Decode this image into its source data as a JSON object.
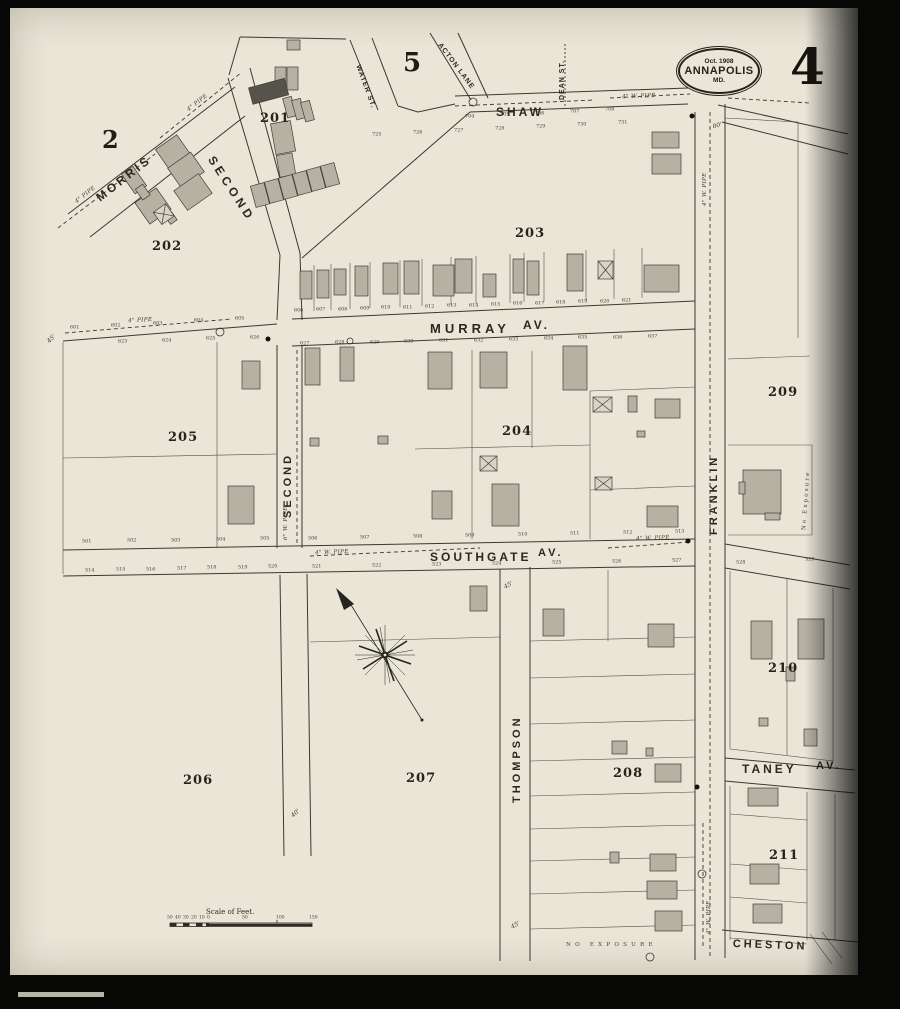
{
  "sheet": {
    "number": "4",
    "badge_date": "Oct. 1908",
    "badge_city": "ANNAPOLIS",
    "badge_state": "MD.",
    "adjacent_top": "5",
    "adjacent_left": "2"
  },
  "streets": {
    "shaw": "SHAW",
    "morris": "MORRIS",
    "second_upper": "SECOND",
    "second_lower": "SECOND",
    "water": "WATER ST.",
    "acton": "ACTON LANE",
    "dean": "DEAN ST.",
    "murray": "MURRAY",
    "murray_av": "AV.",
    "southgate": "SOUTHGATE",
    "southgate_av": "AV.",
    "franklin": "FRANKLIN",
    "thompson": "THOMPSON",
    "taney": "TANEY",
    "taney_av": "AV.",
    "cheston": "CHESTON"
  },
  "blocks": {
    "b201": "201",
    "b202": "202",
    "b203": "203",
    "b204": "204",
    "b205": "205",
    "b206": "206",
    "b207": "207",
    "b208": "208",
    "b209": "209",
    "b210": "210",
    "b211": "211"
  },
  "notes": {
    "no_exposure": "No Exposure",
    "pipe_4w": "4\" W. PIPE",
    "pipe_4": "4\" PIPE",
    "pipe_6w": "6\" W. PIPE",
    "scale_label": "Scale of Feet.",
    "w80": "80'",
    "w40": "40'",
    "w45": "45'"
  },
  "number_rows": [
    {
      "x1": 284,
      "x2": 612,
      "y1": 300,
      "y2": 290,
      "values": [
        "606",
        "607",
        "608",
        "609",
        "610",
        "611",
        "612",
        "613",
        "614",
        "615",
        "616",
        "617",
        "618",
        "619",
        "620",
        "621"
      ]
    },
    {
      "x1": 290,
      "x2": 638,
      "y1": 333,
      "y2": 326,
      "values": [
        "627",
        "628",
        "629",
        "630",
        "631",
        "632",
        "633",
        "634",
        "635",
        "636",
        "637"
      ]
    },
    {
      "x1": 108,
      "x2": 240,
      "y1": 331,
      "y2": 327,
      "values": [
        "623",
        "624",
        "625",
        "626"
      ]
    },
    {
      "x1": 60,
      "x2": 225,
      "y1": 317,
      "y2": 308,
      "values": [
        "601",
        "602",
        "603",
        "604",
        "605"
      ]
    },
    {
      "x1": 72,
      "x2": 250,
      "y1": 531,
      "y2": 528,
      "values": [
        "501",
        "502",
        "503",
        "504",
        "505"
      ]
    },
    {
      "x1": 298,
      "x2": 665,
      "y1": 528,
      "y2": 521,
      "values": [
        "506",
        "507",
        "508",
        "509",
        "510",
        "511",
        "512",
        "513"
      ]
    },
    {
      "x1": 75,
      "x2": 258,
      "y1": 560,
      "y2": 556,
      "values": [
        "514",
        "515",
        "516",
        "517",
        "518",
        "519",
        "520"
      ]
    },
    {
      "x1": 302,
      "x2": 662,
      "y1": 556,
      "y2": 550,
      "values": [
        "521",
        "522",
        "523",
        "524",
        "525",
        "526",
        "527"
      ]
    },
    {
      "x1": 726,
      "x2": 795,
      "y1": 552,
      "y2": 549,
      "values": [
        "528",
        "529"
      ]
    },
    {
      "x1": 455,
      "x2": 595,
      "y1": 106,
      "y2": 99,
      "values": [
        "704",
        "705",
        "706",
        "707",
        "708"
      ]
    },
    {
      "x1": 362,
      "x2": 608,
      "y1": 124,
      "y2": 112,
      "values": [
        "725",
        "726",
        "727",
        "728",
        "729",
        "730",
        "731"
      ]
    },
    {
      "x1": 157,
      "x2": 197,
      "y1": 907,
      "y2": 907,
      "size": 0.56,
      "values": [
        "50",
        "40",
        "30",
        "20",
        "10",
        "0"
      ]
    },
    {
      "x1": 232,
      "x2": 299,
      "y1": 907,
      "y2": 907,
      "size": 0.56,
      "values": [
        "50",
        "100",
        "150"
      ]
    }
  ]
}
